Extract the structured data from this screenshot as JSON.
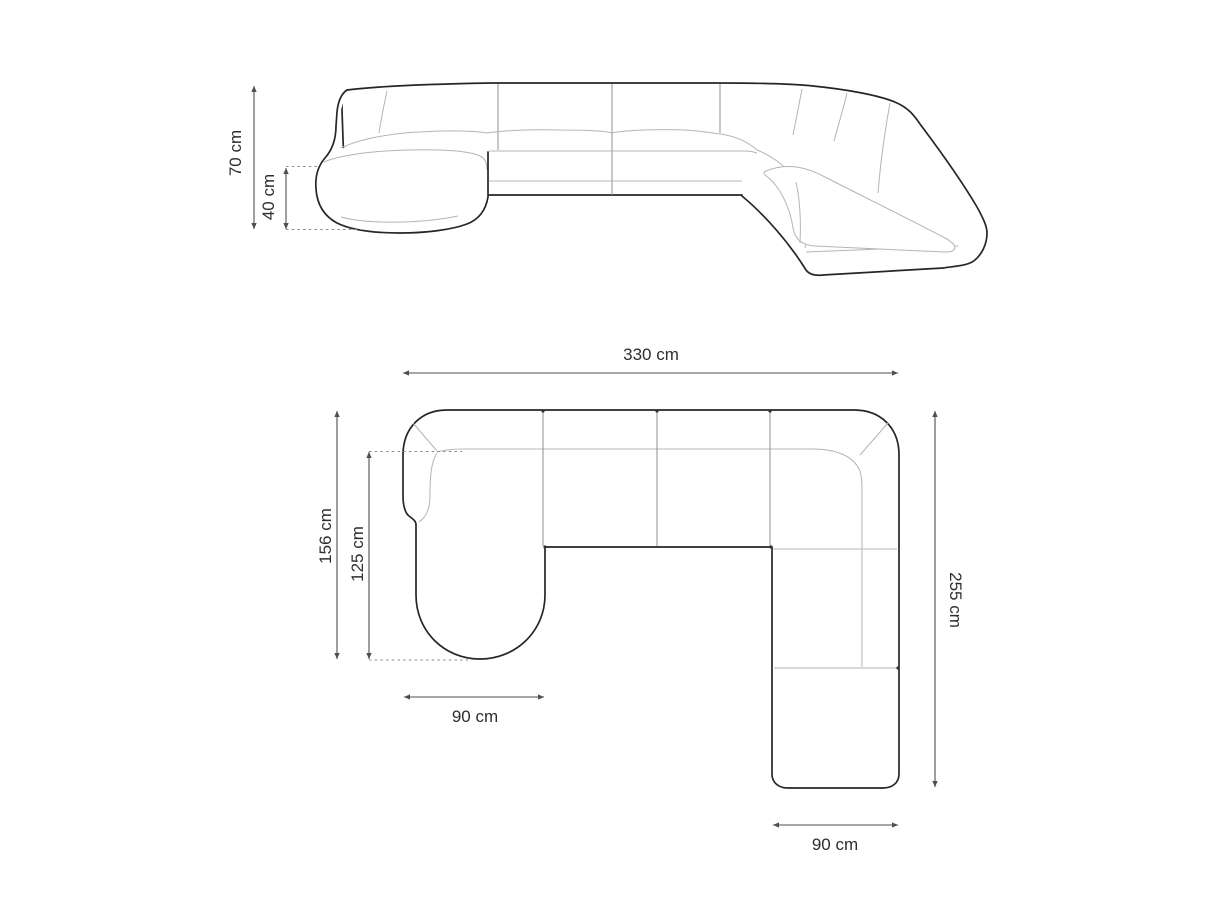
{
  "style": {
    "background": "#ffffff",
    "outline_color": "#262626",
    "seam_color": "#b5b5b5",
    "dim_line_color": "#4f4f4f",
    "text_color": "#2e2e2e"
  },
  "front_view": {
    "total_height": "70 cm",
    "seat_height": "40 cm"
  },
  "plan_view": {
    "total_width": "330 cm",
    "chaise_depth_total": "156 cm",
    "chaise_depth_from_back": "125 cm",
    "chaise_width": "90 cm",
    "total_depth": "255 cm",
    "end_module_width": "90 cm"
  }
}
